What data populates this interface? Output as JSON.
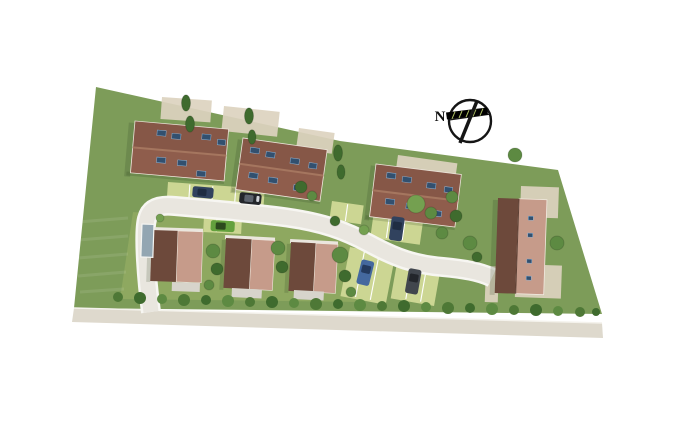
{
  "compass": {
    "label": "N"
  },
  "colors": {
    "grass": "#7d9c59",
    "grass-light": "#90aa62",
    "street": "#ded9cd",
    "road": "#e9e6df",
    "road-edge": "#f7f6f2",
    "roof": "#8f5d4c",
    "roof-ridge": "#a5765f",
    "roof-dark": "#6d493b",
    "roof-light": "#c69b8a",
    "panel": "#32506f",
    "parking": "#ccd693",
    "patio": "#ddd3bf",
    "terrace": "#d7d4cb",
    "carport": "#93a6b2",
    "hedge": "#4e7836",
    "tree": "#5d8a42",
    "tree-dark": "#3f6b2e",
    "tree-light": "#74a050",
    "car-navy": "#31425e",
    "car-black": "#23262b",
    "car-green": "#63a13d",
    "car-blue": "#44689e",
    "car-gray": "#41464d",
    "shadow": "rgba(40,60,25,0.18)"
  },
  "vegetation": {
    "trees": [
      {
        "x": 186,
        "y": 103,
        "r": 4.5,
        "c": "d",
        "t": "c"
      },
      {
        "x": 190,
        "y": 124,
        "r": 4.5,
        "c": "d",
        "t": "c"
      },
      {
        "x": 249,
        "y": 116,
        "r": 4.5,
        "c": "d",
        "t": "c"
      },
      {
        "x": 252,
        "y": 137,
        "r": 4,
        "c": "d",
        "t": "c"
      },
      {
        "x": 338,
        "y": 153,
        "r": 4.5,
        "c": "d",
        "t": "c"
      },
      {
        "x": 341,
        "y": 172,
        "r": 4,
        "c": "d",
        "t": "c"
      },
      {
        "x": 301,
        "y": 187,
        "r": 6,
        "c": "d",
        "t": "r"
      },
      {
        "x": 312,
        "y": 196,
        "r": 5,
        "c": "m",
        "t": "r"
      },
      {
        "x": 416,
        "y": 204,
        "r": 9,
        "c": "l",
        "t": "r"
      },
      {
        "x": 431,
        "y": 213,
        "r": 6,
        "c": "m",
        "t": "r"
      },
      {
        "x": 452,
        "y": 197,
        "r": 6,
        "c": "m",
        "t": "r"
      },
      {
        "x": 456,
        "y": 216,
        "r": 6,
        "c": "d",
        "t": "r"
      },
      {
        "x": 470,
        "y": 243,
        "r": 7,
        "c": "m",
        "t": "r"
      },
      {
        "x": 477,
        "y": 257,
        "r": 5,
        "c": "d",
        "t": "r"
      },
      {
        "x": 515,
        "y": 155,
        "r": 7,
        "c": "m",
        "t": "r"
      },
      {
        "x": 557,
        "y": 243,
        "r": 7,
        "c": "m",
        "t": "r"
      },
      {
        "x": 213,
        "y": 251,
        "r": 7,
        "c": "m",
        "t": "r"
      },
      {
        "x": 217,
        "y": 269,
        "r": 6,
        "c": "d",
        "t": "r"
      },
      {
        "x": 209,
        "y": 285,
        "r": 5,
        "c": "m",
        "t": "r"
      },
      {
        "x": 278,
        "y": 248,
        "r": 7,
        "c": "m",
        "t": "r"
      },
      {
        "x": 282,
        "y": 267,
        "r": 6,
        "c": "d",
        "t": "r"
      },
      {
        "x": 340,
        "y": 255,
        "r": 8,
        "c": "m",
        "t": "r"
      },
      {
        "x": 345,
        "y": 276,
        "r": 6,
        "c": "d",
        "t": "r"
      },
      {
        "x": 351,
        "y": 292,
        "r": 5,
        "c": "m",
        "t": "r"
      },
      {
        "x": 364,
        "y": 230,
        "r": 5,
        "c": "l",
        "t": "r"
      },
      {
        "x": 335,
        "y": 221,
        "r": 5,
        "c": "d",
        "t": "r"
      },
      {
        "x": 442,
        "y": 233,
        "r": 6,
        "c": "m",
        "t": "r"
      },
      {
        "x": 160,
        "y": 218,
        "r": 4,
        "c": "l",
        "t": "r"
      }
    ],
    "hedge": [
      {
        "x": 118,
        "y": 297,
        "r": 5
      },
      {
        "x": 140,
        "y": 298,
        "r": 6
      },
      {
        "x": 162,
        "y": 299,
        "r": 5
      },
      {
        "x": 184,
        "y": 300,
        "r": 6
      },
      {
        "x": 206,
        "y": 300,
        "r": 5
      },
      {
        "x": 228,
        "y": 301,
        "r": 6
      },
      {
        "x": 250,
        "y": 302,
        "r": 5
      },
      {
        "x": 272,
        "y": 302,
        "r": 6
      },
      {
        "x": 294,
        "y": 303,
        "r": 5
      },
      {
        "x": 316,
        "y": 304,
        "r": 6
      },
      {
        "x": 338,
        "y": 304,
        "r": 5
      },
      {
        "x": 360,
        "y": 305,
        "r": 6
      },
      {
        "x": 382,
        "y": 306,
        "r": 5
      },
      {
        "x": 404,
        "y": 306,
        "r": 6
      },
      {
        "x": 426,
        "y": 307,
        "r": 5
      },
      {
        "x": 448,
        "y": 308,
        "r": 6
      },
      {
        "x": 470,
        "y": 308,
        "r": 5
      },
      {
        "x": 492,
        "y": 309,
        "r": 6
      },
      {
        "x": 514,
        "y": 310,
        "r": 5
      },
      {
        "x": 536,
        "y": 310,
        "r": 6
      },
      {
        "x": 558,
        "y": 311,
        "r": 5
      },
      {
        "x": 580,
        "y": 312,
        "r": 5
      },
      {
        "x": 596,
        "y": 312,
        "r": 4
      }
    ]
  }
}
